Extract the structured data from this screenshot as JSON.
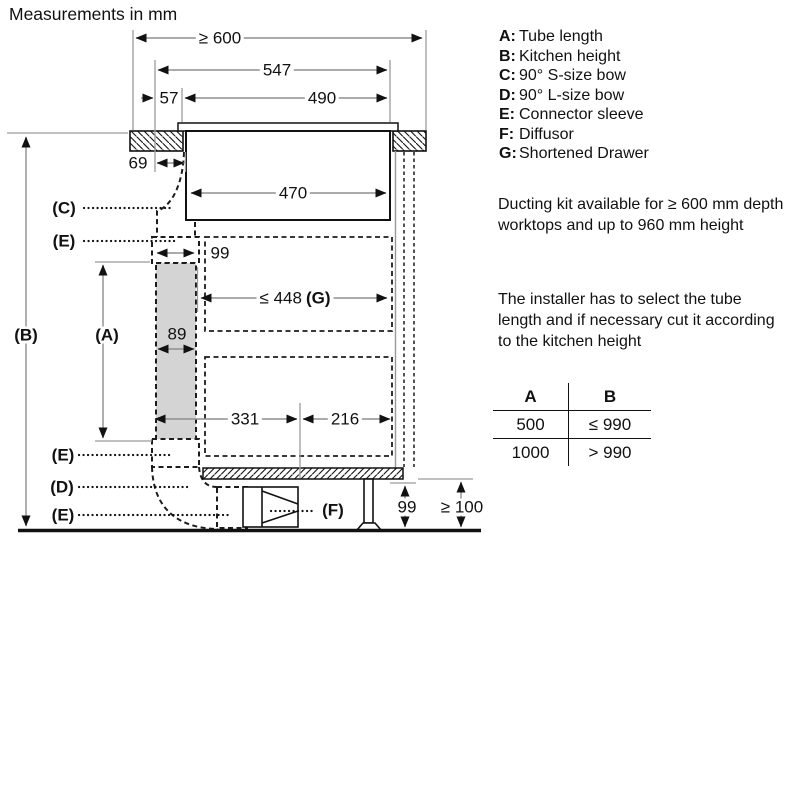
{
  "title": "Measurements in mm",
  "colors": {
    "line": "#111111",
    "dim_line": "#8f8f8f",
    "tube_fill": "#d4d4d4"
  },
  "legend": {
    "items": [
      {
        "key": "A:",
        "label": "Tube length"
      },
      {
        "key": "B:",
        "label": "Kitchen height"
      },
      {
        "key": "C:",
        "label": "90° S-size bow"
      },
      {
        "key": "D:",
        "label": "90° L-size bow"
      },
      {
        "key": "E:",
        "label": "Connector sleeve"
      },
      {
        "key": "F:",
        "label": "Diffusor"
      },
      {
        "key": "G:",
        "label": "Shortened Drawer"
      }
    ]
  },
  "notes": {
    "note1": "Ducting kit available for ≥ 600 mm depth worktops and up to 960 mm height",
    "note2": "The installer has to select the tube length and if necessary cut it according to the kitchen height"
  },
  "table": {
    "columns": [
      "A",
      "B"
    ],
    "rows": [
      [
        "500",
        "≤ 990"
      ],
      [
        "1000",
        "> 990"
      ]
    ]
  },
  "diagram": {
    "dims": {
      "worktop_depth": "≥ 600",
      "d547": "547",
      "d57": "57",
      "d490": "490",
      "d69": "69",
      "d470": "470",
      "sleeve_width": "99",
      "drawer_value": "≤ 448",
      "drawer_ref": "(G)",
      "tube_width": "89",
      "d331": "331",
      "d216": "216",
      "plinth_height": "99",
      "floor_clearance": "≥ 100"
    },
    "callouts": {
      "c": "(C)",
      "e_top": "(E)",
      "b": "(B)",
      "a": "(A)",
      "e_mid": "(E)",
      "d": "(D)",
      "e_bottom": "(E)",
      "f": "(F)"
    }
  }
}
